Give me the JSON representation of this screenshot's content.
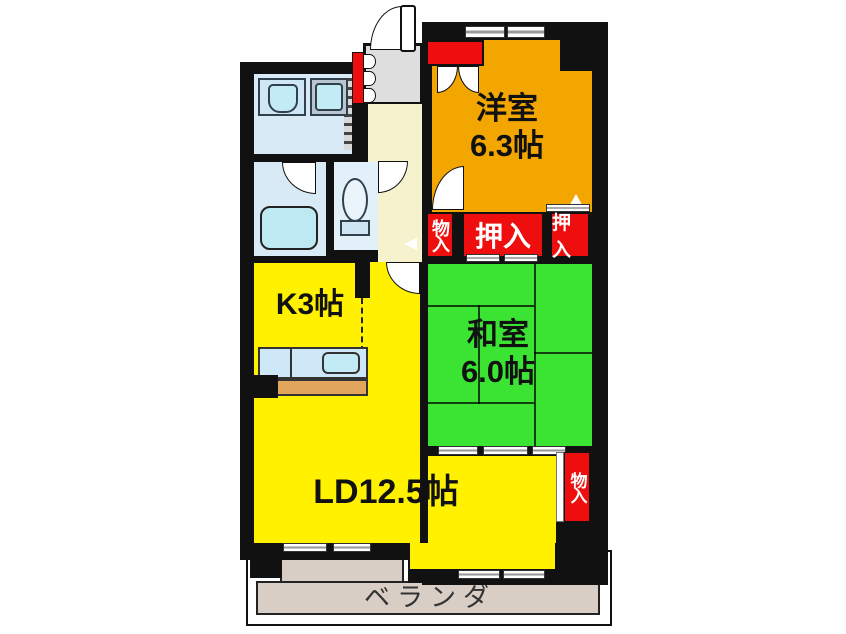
{
  "plan_title": "apartment floor plan",
  "rooms": {
    "western": {
      "name": "洋室",
      "size": "6.3帖"
    },
    "japanese": {
      "name": "和室",
      "size": "6.0帖"
    },
    "kitchen": {
      "label": "K3帖"
    },
    "living": {
      "label": "LD12.5帖"
    },
    "veranda": {
      "label": "ベランダ"
    }
  },
  "closets": {
    "storage_hall": "物入",
    "oshiire_main": "押入",
    "oshiire_side": "押入",
    "storage_ld": "物入"
  },
  "colors": {
    "wall": "#111111",
    "western_room": "#f4a600",
    "japanese_room": "#3be432",
    "kitchen_living": "#fff100",
    "closet_red": "#ee0e0e",
    "hallway": "#f6f2cd",
    "entrance_gray": "#dedede",
    "wet_rooms": "#d9eaf7",
    "fixture_cyan": "#c3ebf6",
    "counter_tan": "#e2a55c",
    "veranda_floor": "#d8cec6"
  }
}
